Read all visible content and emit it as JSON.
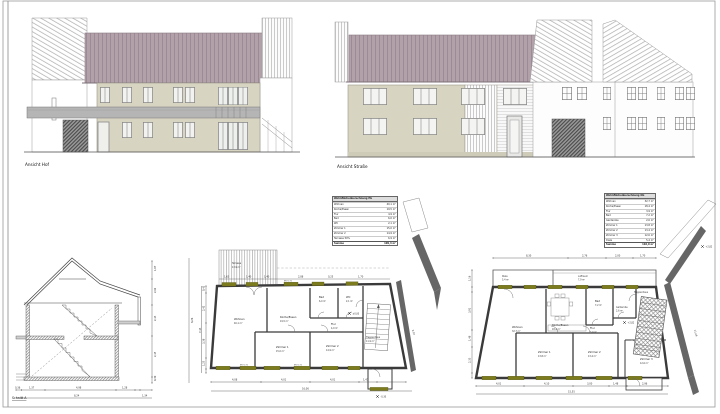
{
  "labels": {
    "hof": "Ansicht Hof",
    "strasse": "Ansicht Straße",
    "schnitt": "Schnitt A"
  },
  "colors": {
    "roof": "#b3a1aa",
    "roof_stripe": "#9c8a94",
    "wall": "#d8d4c2",
    "olive_window": "#7c7c1e",
    "dark_wall": "#666666"
  },
  "section": {
    "dims_right": [
      "1,07",
      "2,62",
      "2,43",
      "2,45",
      "0,30"
    ],
    "dim_right_total": "8,26",
    "dims_bottom": [
      "0,36",
      "1,37",
      "4,98",
      "1,28",
      "0,36"
    ],
    "dim_bottom_total": "8,24",
    "dim_bottom_extra": "1,34"
  },
  "eg": {
    "table": {
      "title": "Wohnflächenberechnung EG",
      "rows": [
        {
          "n": "Wohnen",
          "v": "40,1 m²"
        },
        {
          "n": "Küche/Essen",
          "v": "19,5 m²"
        },
        {
          "n": "Flur",
          "v": "4,9 m²"
        },
        {
          "n": "Bad",
          "v": "6,0 m²"
        },
        {
          "n": "WC",
          "v": "2,1 m²"
        },
        {
          "n": "Zimmer 1",
          "v": "15,0 m²"
        },
        {
          "n": "Zimmer 2",
          "v": "14,9 m²"
        },
        {
          "n": "Terrasse 50%",
          "v": "6,9 m²"
        }
      ],
      "sum_label": "Summe",
      "sum_value": "109,4 m²"
    },
    "rooms": [
      {
        "n": "Wohnen",
        "a": "40,1 m²"
      },
      {
        "n": "Küche/Essen",
        "a": "19,5 m²"
      },
      {
        "n": "Flur",
        "a": "4,9 m²"
      },
      {
        "n": "Bad",
        "a": "6,0 m²"
      },
      {
        "n": "WC",
        "a": "2,1 m²"
      },
      {
        "n": "Zimmer 1",
        "a": "15,0 m²"
      },
      {
        "n": "Zimmer 2",
        "a": "14,9 m²"
      },
      {
        "n": "Treppenhaus",
        "a": "11,9 m²"
      },
      {
        "n": "Terrasse",
        "a": "13,9 m²"
      }
    ],
    "dims_bottom": [
      "4,08",
      "4,01",
      "4,01",
      "1,47"
    ],
    "dim_bottom_total": "16,06",
    "dims_left": [
      "0,42",
      "2,42",
      "3,38",
      "1,25",
      "0,42"
    ],
    "dim_left_total": "7,43",
    "dims_top": [
      "1,63",
      "1,40",
      "1,40",
      "2,88",
      "0,25",
      "1,70"
    ],
    "dim_diag": "9,07",
    "marks": {
      "zero": "±0,00",
      "minus": "-0,30"
    },
    "brh": "BRH 0,90"
  },
  "og": {
    "table": {
      "title": "Wohnflächenberechnung OG",
      "rows": [
        {
          "n": "Wohnen",
          "v": "32,7 m²"
        },
        {
          "n": "Küche/Essen",
          "v": "18,4 m²"
        },
        {
          "n": "Flur",
          "v": "3,9 m²"
        },
        {
          "n": "Bad",
          "v": "7,2 m²"
        },
        {
          "n": "Garderobe",
          "v": "2,6 m²"
        },
        {
          "n": "Zimmer 1",
          "v": "13,8 m²"
        },
        {
          "n": "Zimmer 2",
          "v": "13,4 m²"
        },
        {
          "n": "Zimmer 3",
          "v": "12,6 m²"
        },
        {
          "n": "Diele",
          "v": "5,4 m²"
        }
      ],
      "sum_label": "Summe",
      "sum_value": "110,0 m²"
    },
    "rooms": [
      {
        "n": "Wohnen",
        "a": "32,7 m²"
      },
      {
        "n": "Küche/Essen",
        "a": "18,4 m²"
      },
      {
        "n": "Flur",
        "a": "3,9 m²"
      },
      {
        "n": "Bad",
        "a": "7,2 m²"
      },
      {
        "n": "Garderobe",
        "a": "2,6 m²"
      },
      {
        "n": "Zimmer 1",
        "a": "13,8 m²"
      },
      {
        "n": "Zimmer 2",
        "a": "13,4 m²"
      },
      {
        "n": "Zimmer 3",
        "a": "12,6 m²"
      },
      {
        "n": "Treppenhaus",
        "a": "11,9 m²"
      },
      {
        "n": "Diele",
        "a": "5,4 m²"
      },
      {
        "n": "Luftraum",
        "a": "7,9 m²"
      }
    ],
    "dims_bottom": [
      "4,01",
      "4,10",
      "3,00",
      "1,48",
      "2,96"
    ],
    "dim_bottom_total": "15,55",
    "dims_left": [
      "1,16",
      "0,42",
      "3,91",
      "1,48",
      "2,33",
      "0,42"
    ],
    "dims_top": [
      "8,30",
      "2,76",
      "2,00",
      "1,70"
    ],
    "dim_diag": "11,46",
    "marks": {
      "plus": "+2,82"
    },
    "brh": "BRH 0,90"
  }
}
